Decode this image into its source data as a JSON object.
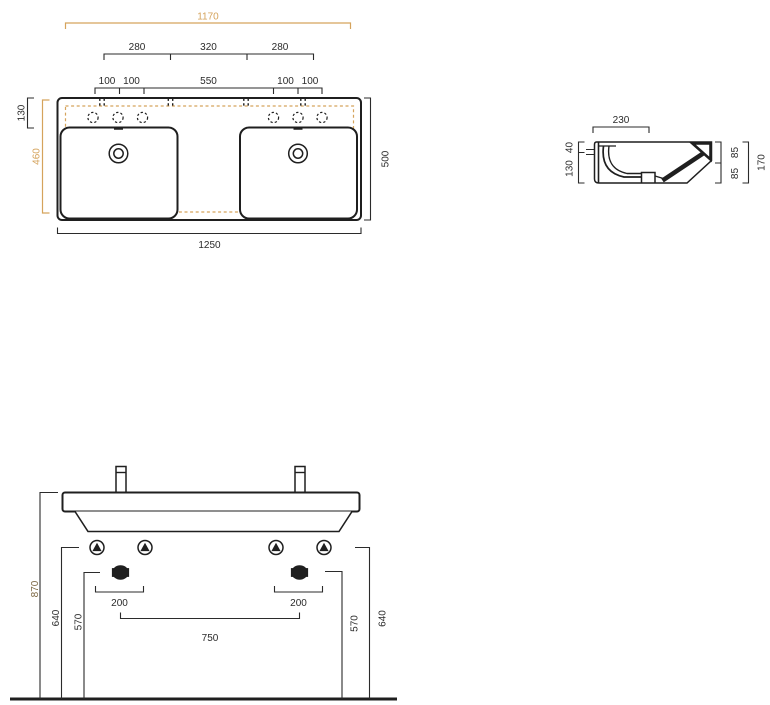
{
  "colors": {
    "ink": "#1f1f1f",
    "dim": "#2b2b2b",
    "accent": "#d5a35c",
    "total": "#7d6844",
    "bg": "#ffffff"
  },
  "plan_view": {
    "tap_ledge_width": "1170",
    "tap_group_left_span": "280",
    "tap_center_span": "320",
    "tap_group_right_span": "280",
    "hole_pitch_l1": "100",
    "hole_pitch_l2": "100",
    "hole_center_span": "550",
    "hole_pitch_r1": "100",
    "hole_pitch_r2": "100",
    "ledge_depth": "130",
    "bowl_depth": "460",
    "total_depth": "500",
    "total_width": "1250"
  },
  "section_view": {
    "bowl_top_width": "230",
    "rim_thickness": "40",
    "apron_height": "130",
    "upper_height": "85",
    "lower_height": "85",
    "total_height": "170"
  },
  "front_view": {
    "rim_height_from_floor": "870",
    "fixing_height_left": "640",
    "waste_height_left": "570",
    "fixing_pitch_left": "200",
    "fixing_pitch_right": "200",
    "fixing_span": "750",
    "waste_height_right": "570",
    "fixing_height_right": "640"
  }
}
